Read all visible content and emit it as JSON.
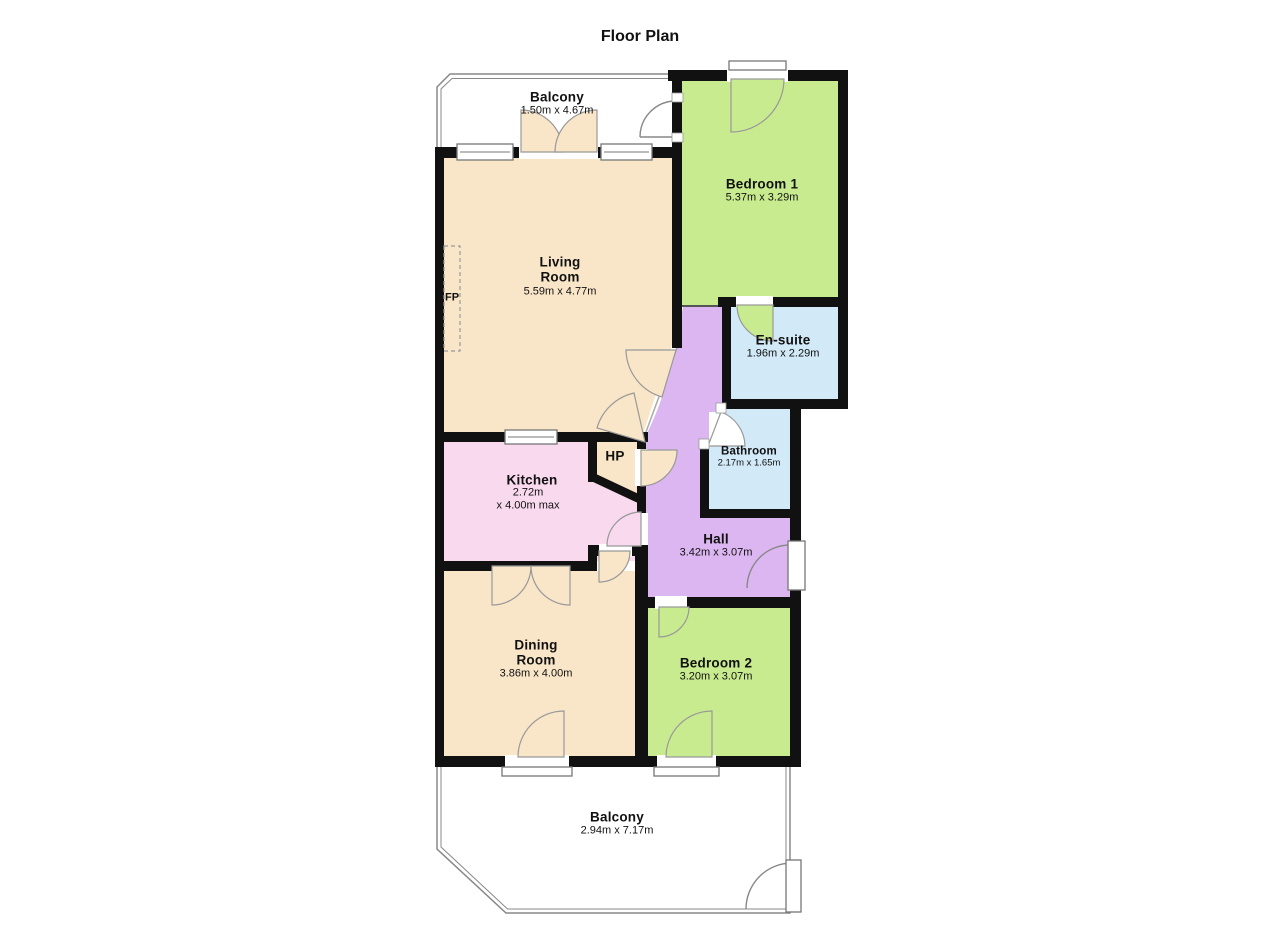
{
  "title": "Floor Plan",
  "colors": {
    "wall": "#111111",
    "room_cream": "#f9e6c8",
    "room_green": "#c9eb8f",
    "room_blue": "#d2e9f7",
    "room_pink": "#f8d9ee",
    "room_purple": "#dcb6f0",
    "thin_line": "#888888"
  },
  "rooms": {
    "balcony_top": {
      "name": "Balcony",
      "dims": "1.50m x 4.67m"
    },
    "bedroom1": {
      "name": "Bedroom 1",
      "dims": "5.37m x 3.29m"
    },
    "living": {
      "name_line1": "Living",
      "name_line2": "Room",
      "dims": "5.59m x 4.77m"
    },
    "ensuite": {
      "name": "En-suite",
      "dims": "1.96m x 2.29m"
    },
    "kitchen": {
      "name": "Kitchen",
      "dims_line1": "2.72m",
      "dims_line2": "x 4.00m max"
    },
    "hp": {
      "name": "HP"
    },
    "bathroom": {
      "name": "Bathroom",
      "dims": "2.17m x 1.65m"
    },
    "hall": {
      "name": "Hall",
      "dims": "3.42m x 3.07m"
    },
    "dining": {
      "name_line1": "Dining",
      "name_line2": "Room",
      "dims": "3.86m x 4.00m"
    },
    "bedroom2": {
      "name": "Bedroom 2",
      "dims": "3.20m x 3.07m"
    },
    "balcony_bottom": {
      "name": "Balcony",
      "dims": "2.94m x 7.17m"
    },
    "fireplace": {
      "name": "FP"
    }
  }
}
